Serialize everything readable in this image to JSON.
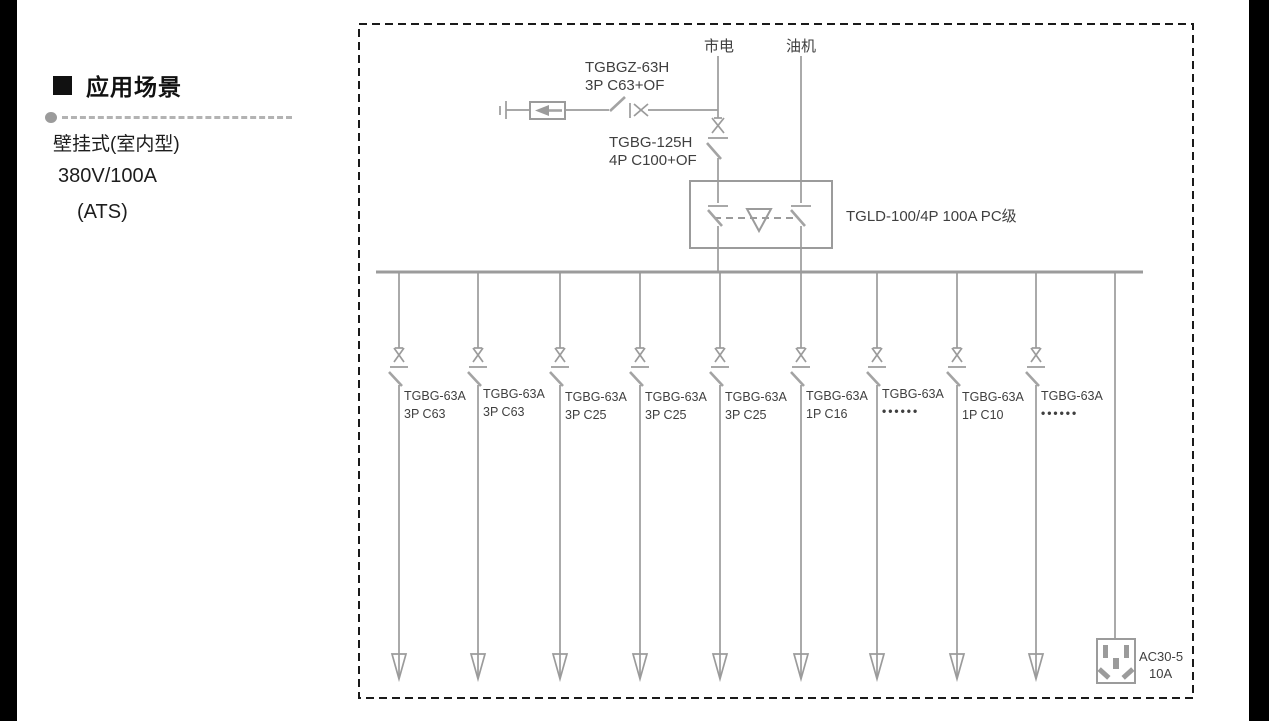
{
  "page": {
    "background": "#ffffff",
    "side_bar_color": "#000000"
  },
  "sidebar": {
    "heading": "应用场景",
    "bullet": "black-square",
    "lines": [
      {
        "text": "壁挂式(室内型)"
      },
      {
        "text": "380V/100A"
      },
      {
        "text": "(ATS)"
      }
    ]
  },
  "diagram": {
    "colors": {
      "wire": "#9b9b9b",
      "text": "#3f3f3f",
      "frame": "#1a1a1a"
    },
    "sources": [
      {
        "label": "市电"
      },
      {
        "label": "油机"
      }
    ],
    "spd_branch": {
      "label_line1": "TGBGZ-63H",
      "label_line2": "3P C63+OF"
    },
    "incomer_breaker": {
      "label_line1": "TGBG-125H",
      "label_line2": "4P C100+OF"
    },
    "ats": {
      "label": "TGLD-100/4P 100A PC级"
    },
    "branches": [
      {
        "line1": "TGBG-63A",
        "line2": "3P C63"
      },
      {
        "line1": "TGBG-63A",
        "line2": "3P C63"
      },
      {
        "line1": "TGBG-63A",
        "line2": "3P C25"
      },
      {
        "line1": "TGBG-63A",
        "line2": "3P C25"
      },
      {
        "line1": "TGBG-63A",
        "line2": "3P C25"
      },
      {
        "line1": "TGBG-63A",
        "line2": "1P C16"
      },
      {
        "line1": "TGBG-63A",
        "line2": "••••••"
      },
      {
        "line1": "TGBG-63A",
        "line2": "1P C10"
      },
      {
        "line1": "TGBG-63A",
        "line2": "••••••"
      }
    ],
    "socket": {
      "label_line1": "AC30-5",
      "label_line2": "10A"
    }
  }
}
